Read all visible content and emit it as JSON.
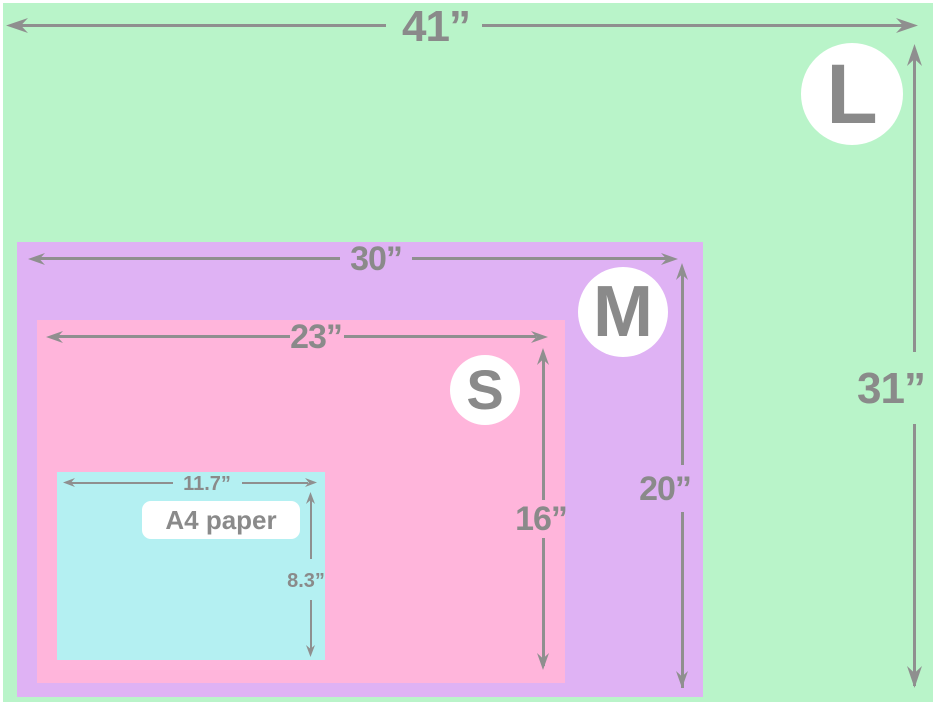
{
  "colors": {
    "green": "#b9f4c9",
    "purple": "#dfb2f4",
    "pink": "#ffb5db",
    "cyan": "#b4f0f2",
    "line": "#8f8f8f",
    "text": "#8a8a8a",
    "white": "#ffffff"
  },
  "sizes": {
    "large": {
      "badge": "L",
      "width": "41”",
      "height": "31”"
    },
    "medium": {
      "badge": "M",
      "width": "30”",
      "height": "20”"
    },
    "small": {
      "badge": "S",
      "width": "23”",
      "height": "16”"
    },
    "a4": {
      "label": "A4 paper",
      "width": "11.7”",
      "height": "8.3”"
    }
  }
}
